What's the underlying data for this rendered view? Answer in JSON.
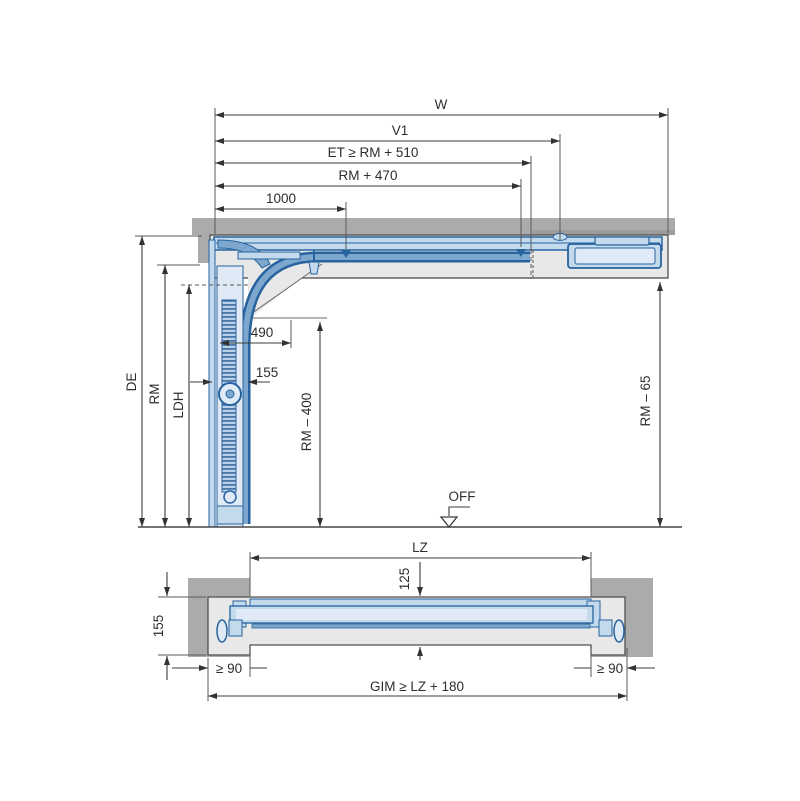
{
  "section_view": {
    "dims": {
      "w": "W",
      "v1": "V1",
      "et": "ET ≥ RM + 510",
      "rm470": "RM + 470",
      "d1000": "1000",
      "d490": "490",
      "d155": "155",
      "de": "DE",
      "rm": "RM",
      "ldh": "LDH",
      "rm400": "RM – 400",
      "rm65": "RM – 65"
    },
    "floor_marker": "OFF"
  },
  "plan_view": {
    "dims": {
      "lz": "LZ",
      "d125": "125",
      "d155": "155",
      "g90_left": "≥ 90",
      "g90_right": "≥ 90",
      "gim": "GIM ≥ LZ + 180"
    }
  },
  "colors": {
    "wall": "#ababab",
    "frame": "#e8e8e8",
    "blue_dark": "#27639f",
    "blue_mid": "#7da7cd",
    "blue_light": "#c3d9ec",
    "blue_pale": "#dfeaf6",
    "dim_line": "#3d3d3d"
  }
}
